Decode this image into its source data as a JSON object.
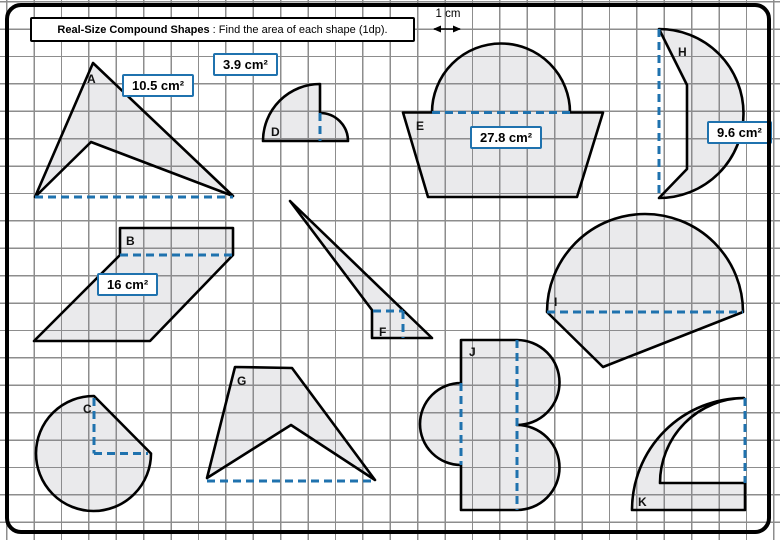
{
  "header": {
    "title_bold": "Real-Size Compound Shapes",
    "title_rest": " : Find the area of each shape (1dp).",
    "scale_label": "1 cm"
  },
  "letters": {
    "a": "A",
    "b": "B",
    "c": "C",
    "d": "D",
    "e": "E",
    "f": "F",
    "g": "G",
    "h": "H",
    "i": "I",
    "j": "J",
    "k": "K"
  },
  "area_labels": [
    {
      "text": "10.5 cm²"
    },
    {
      "text": "3.9 cm²"
    },
    {
      "text": "27.8 cm²"
    },
    {
      "text": "9.6 cm²"
    },
    {
      "text": "16 cm²"
    }
  ],
  "colors": {
    "accent_blue": "#1f72ae",
    "grid_line": "#8d8d8d",
    "shape_outline": "#000000",
    "shape_fill": "#ececee"
  }
}
